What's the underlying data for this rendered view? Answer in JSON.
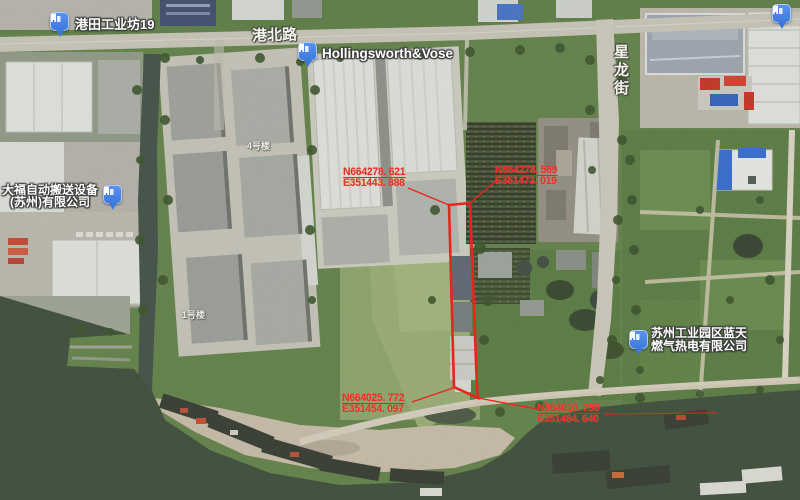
{
  "map": {
    "pois": [
      {
        "label": "港田工业坊19"
      },
      {
        "label": "Hollingsworth&Vose"
      },
      {
        "line1": "大福自动搬送设备",
        "line2": "(苏州)有限公司"
      },
      {
        "line1": "苏州工业园区蓝天",
        "line2": "燃气热电有限公司"
      }
    ],
    "roads": [
      {
        "label": "港北路"
      },
      {
        "label": "星龙街"
      }
    ],
    "buildings": [
      {
        "label": "4号楼"
      },
      {
        "label": "1号楼"
      }
    ]
  },
  "annotations": {
    "stroke_color": "#e8251c",
    "text_color": "#e73126",
    "points": [
      {
        "id": "parcel-top-left",
        "n": "N664278. 621",
        "e": "E351443. 888"
      },
      {
        "id": "parcel-top-right",
        "n": "N664278. 569",
        "e": "E351473. 019"
      },
      {
        "id": "parcel-bottom-left",
        "n": "N664025. 772",
        "e": "E351454. 097"
      },
      {
        "id": "parcel-bottom-right",
        "n": "N664010. 756",
        "e": "E351484. 640"
      }
    ]
  }
}
